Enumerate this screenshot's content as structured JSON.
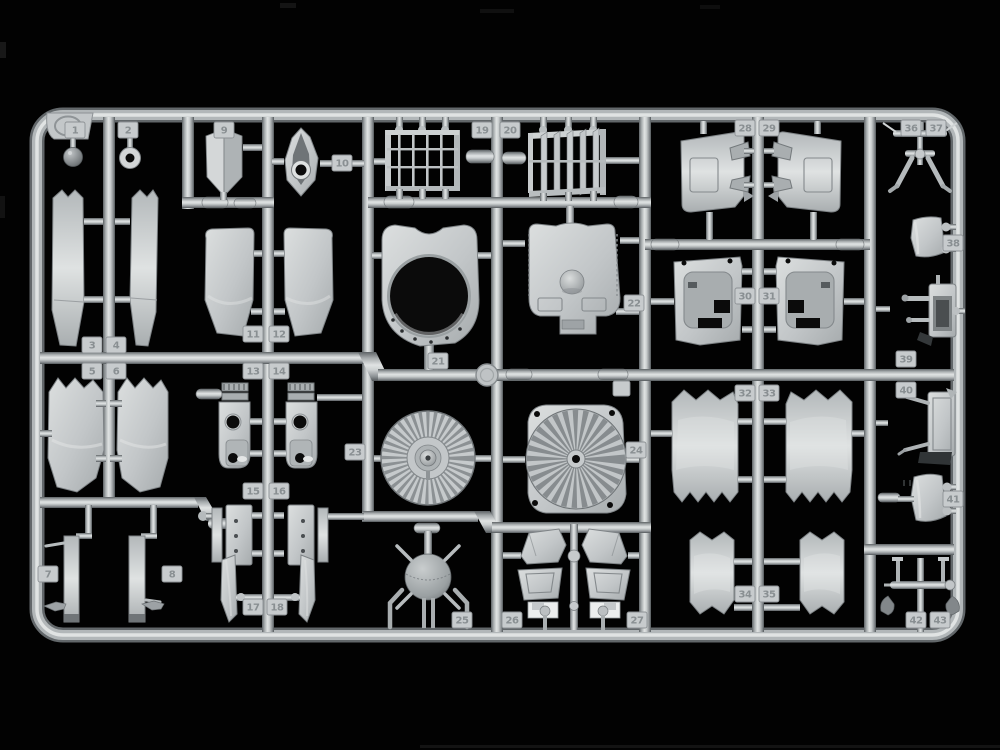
{
  "scene": {
    "description": "Light-gray injection-molded plastic model-kit parts sprue photographed on a black background",
    "sprue_letter": "V",
    "plastic_color": "#c5c9cb",
    "background_color": "#000000",
    "labeled_parts": 43
  },
  "tags": {
    "t1": "1",
    "t2": "2",
    "t3": "3",
    "t4": "4",
    "t5": "5",
    "t6": "6",
    "t7": "7",
    "t8": "8",
    "t9": "9",
    "t10": "10",
    "t11": "11",
    "t12": "12",
    "t13": "13",
    "t14": "14",
    "t15": "15",
    "t16": "16",
    "t17": "17",
    "t18": "18",
    "t19": "19",
    "t20": "20",
    "t21": "21",
    "t22": "22",
    "t23": "23",
    "t24": "24",
    "t25": "25",
    "t26": "26",
    "t27": "27",
    "t28": "28",
    "t29": "29",
    "t30": "30",
    "t31": "31",
    "t32": "32",
    "t33": "33",
    "t34": "34",
    "t35": "35",
    "t36": "36",
    "t37": "37",
    "t38": "38",
    "t39": "39",
    "t40": "40",
    "t41": "41",
    "t42": "42",
    "t43": "43"
  }
}
